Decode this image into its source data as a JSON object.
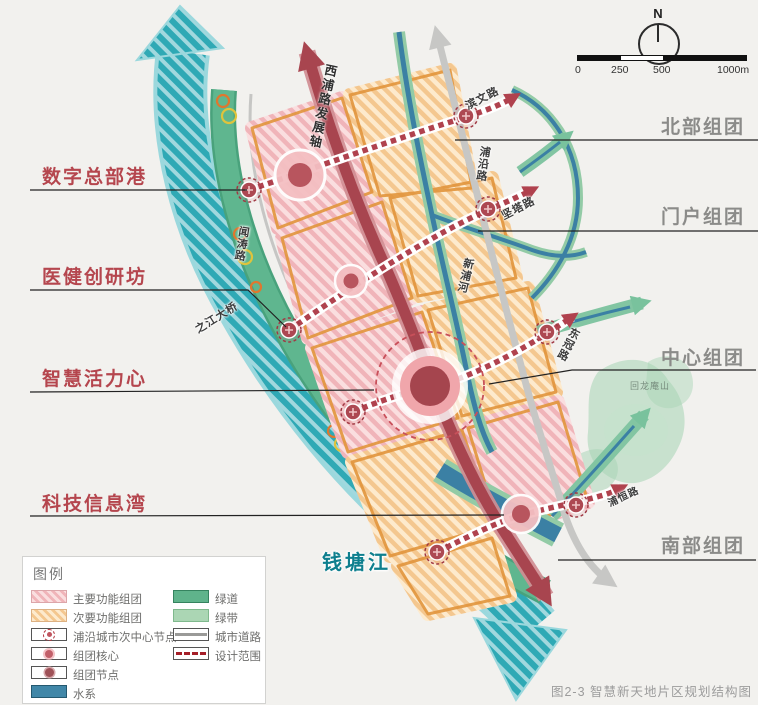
{
  "figure": {
    "caption": "图2-3 智慧新天地片区规划结构图"
  },
  "compass": {
    "north_label": "N"
  },
  "scalebar": {
    "ticks": [
      "0",
      "250",
      "500",
      "1000m"
    ]
  },
  "zones_left": [
    {
      "label": "数字总部港"
    },
    {
      "label": "医健创研坊"
    },
    {
      "label": "智慧活力心"
    },
    {
      "label": "科技信息湾"
    }
  ],
  "zones_right": [
    {
      "label": "北部组团"
    },
    {
      "label": "门户组团"
    },
    {
      "label": "中心组团"
    },
    {
      "label": "南部组团"
    }
  ],
  "map_labels": {
    "development_axis": "西浦路发展轴",
    "river": "钱塘江",
    "mountain": "回龙庵山",
    "roads": [
      {
        "name": "滨文路"
      },
      {
        "name": "浦沿路"
      },
      {
        "name": "坚塔路"
      },
      {
        "name": "新浦河"
      },
      {
        "name": "东冠路"
      },
      {
        "name": "闻涛路"
      },
      {
        "name": "之江大桥"
      },
      {
        "name": "浦恒路"
      }
    ]
  },
  "legend": {
    "title": "图例",
    "col1": [
      {
        "label": "主要功能组团",
        "type": "main-cluster"
      },
      {
        "label": "次要功能组团",
        "type": "secondary-cluster"
      },
      {
        "label": "浦沿城市次中心节点",
        "type": "subcenter-node"
      },
      {
        "label": "组团核心",
        "type": "cluster-core"
      },
      {
        "label": "组团节点",
        "type": "cluster-node"
      },
      {
        "label": "水系",
        "type": "water"
      }
    ],
    "col2": [
      {
        "label": "绿道",
        "type": "greenway"
      },
      {
        "label": "绿带",
        "type": "greenbelt"
      },
      {
        "label": "城市道路",
        "type": "urban-road"
      },
      {
        "label": "设计范围",
        "type": "design-scope"
      }
    ]
  },
  "colors": {
    "main_cluster_hatch": "#f0b4b9",
    "secondary_cluster_hatch": "#f4c78f",
    "water_blue": "#3b80a4",
    "greenway_green": "#5fb68f",
    "greenbelt_green": "#abd6b4",
    "river_teal": "#2fa9b5",
    "axis_red": "#a8454f",
    "dotted_axis_red": "#b0424e",
    "urban_road_gray": "#c7c7c5",
    "zone_label_red": "#b5464e",
    "zone_label_gray": "#8b8b89"
  }
}
